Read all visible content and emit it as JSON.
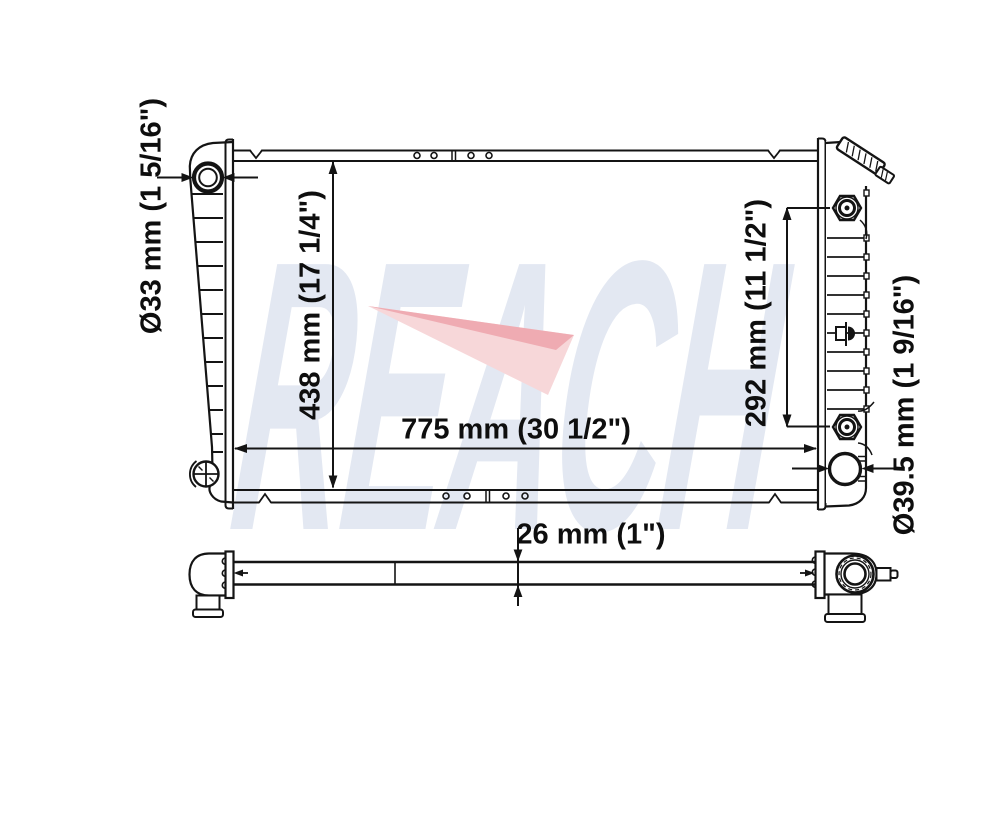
{
  "watermark": {
    "text": "REACH",
    "text_color": "#e3e8f2",
    "swoosh_color": "#f7d7d9",
    "swoosh_accent_color": "#eda6ad"
  },
  "diagram": {
    "type": "radiator-technical-drawing",
    "line_color": "#141414",
    "background": "#ffffff",
    "labels": {
      "inlet_diameter": "Ø33 mm (1 5/16\")",
      "core_height": "438 mm (17 1/4\")",
      "core_width": "775 mm (30 1/2\")",
      "fitting_span": "292 mm (11 1/2\")",
      "outlet_diameter": "Ø39.5 mm (1 9/16\")",
      "core_thickness": "26 mm (1\")"
    }
  }
}
